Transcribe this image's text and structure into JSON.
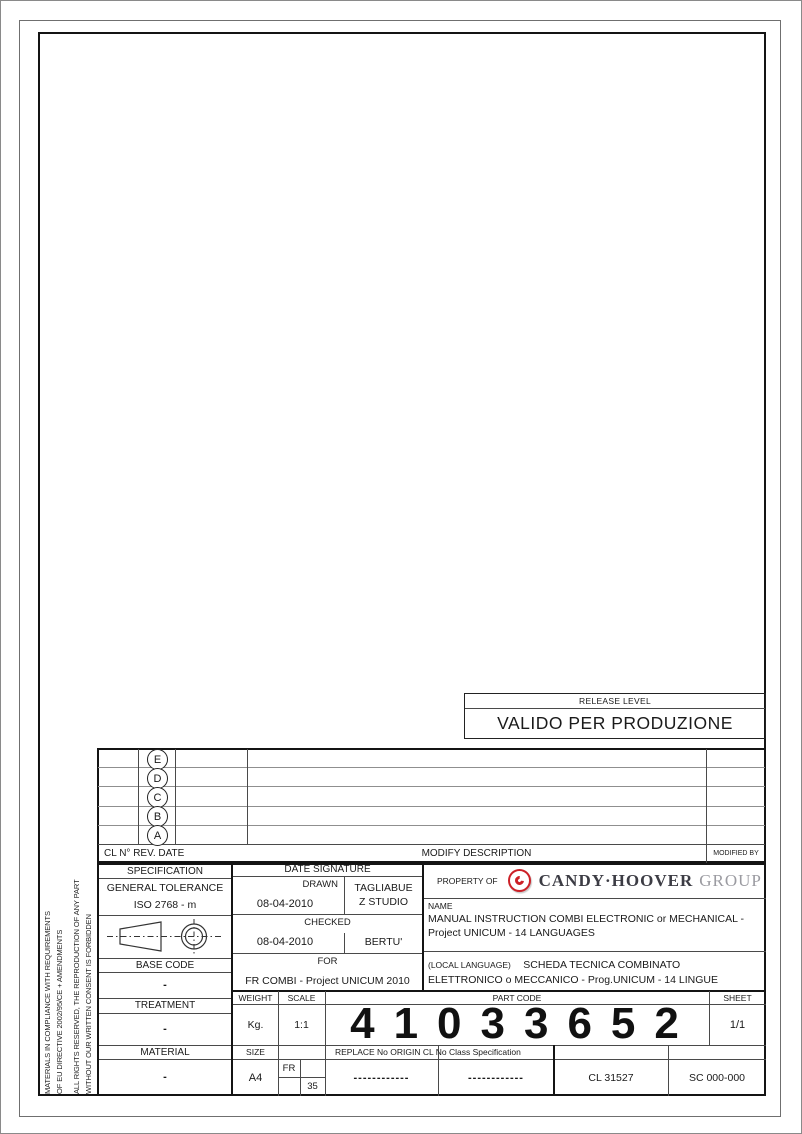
{
  "side_note": {
    "line1": "MATERIALS IN COMPLIANCE WITH REQUIREMENTS",
    "line2": "OF EU DIRECTIVE 2002/95/CE + AMENDMENTS",
    "line3": "ALL RIGHTS RESERVED, THE REPRODUCTION OF ANY PART",
    "line4": "WITHOUT OUR WRITTEN CONSENT IS FORBIDDEN"
  },
  "release": {
    "header": "RELEASE LEVEL",
    "value": "VALIDO PER PRODUZIONE"
  },
  "revision_table": {
    "rows": [
      {
        "letter": "E"
      },
      {
        "letter": "D"
      },
      {
        "letter": "C"
      },
      {
        "letter": "B"
      },
      {
        "letter": "A"
      }
    ],
    "header_left": "CL N° REV. DATE",
    "header_center": "MODIFY DESCRIPTION",
    "header_right": "MODIFIED BY"
  },
  "spec": {
    "specification_label": "SPECIFICATION",
    "general_tolerance_label": "GENERAL TOLERANCE",
    "general_tolerance_value": "ISO 2768 - m",
    "base_code_label": "BASE CODE",
    "base_code_value": "-",
    "treatment_label": "TREATMENT",
    "treatment_value": "-",
    "material_label": "MATERIAL",
    "material_value": "-"
  },
  "signatures": {
    "header": "DATE SIGNATURE",
    "drawn_label": "DRAWN",
    "drawn_date": "08-04-2010",
    "drawn_signature_line1": "TAGLIABUE",
    "drawn_signature_line2": "Z STUDIO",
    "checked_label": "CHECKED",
    "checked_date": "08-04-2010",
    "checked_signature": "BERTU'",
    "for_label": "FOR",
    "for_value": "FR COMBI - Project UNICUM 2010"
  },
  "property": {
    "label": "PROPERTY OF",
    "brand": "CANDY·HOOVER",
    "brand_suffix": "GROUP",
    "brand_color": "#3c3c44",
    "suffix_color": "#9b9ba1",
    "logo_red": "#cc2027",
    "logo_icon": "candy-c-icon"
  },
  "name": {
    "label": "NAME",
    "line1": "MANUAL INSTRUCTION COMBI ELECTRONIC or MECHANICAL -",
    "line2": "Project UNICUM - 14 LANGUAGES"
  },
  "local": {
    "label": "(LOCAL LANGUAGE)",
    "line1": "SCHEDA TECNICA COMBINATO",
    "line2": "ELETTRONICO o MECCANICO - Prog.UNICUM - 14 LINGUE"
  },
  "bottom": {
    "weight_label": "WEIGHT",
    "weight_value": "Kg.",
    "scale_label": "SCALE",
    "scale_value": "1:1",
    "part_code_label": "PART CODE",
    "part_code_value": "41033652",
    "sheet_label": "SHEET",
    "sheet_value": "1/1",
    "size_label": "SIZE",
    "size_value": "A4",
    "fr_label": "FR",
    "fr_number": "35",
    "replace_label": "REPLACE No ORIGIN CL No Class Specification",
    "replace_value": "------------",
    "origin_value": "------------",
    "cl_value": "CL 31527",
    "sc_value": "SC 000-000"
  }
}
